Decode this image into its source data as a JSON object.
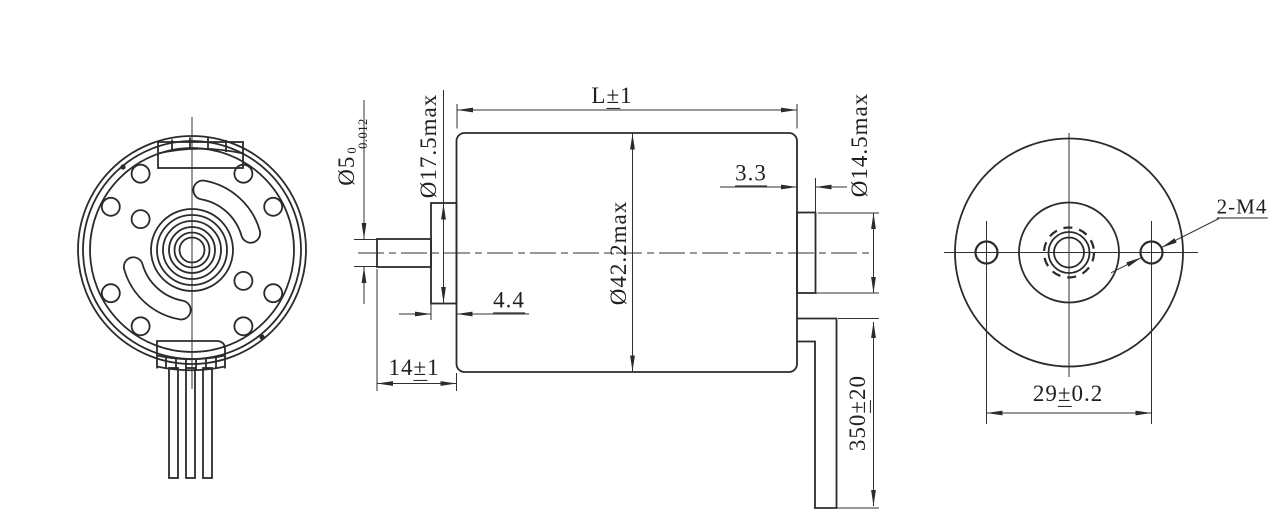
{
  "palette": {
    "background": "#ffffff",
    "line_color": "#2b2b2b"
  },
  "dimensions": {
    "body_length": {
      "prefix": "L",
      "pm": "±",
      "suffix": "1"
    },
    "shaft_diameter": {
      "value": "Ø5",
      "tol_upper": "0",
      "tol_lower": "-0.012"
    },
    "front_boss_diameter": {
      "value": "Ø17.5max"
    },
    "body_diameter": {
      "value": "Ø42.2max"
    },
    "rear_boss_diameter": {
      "value": "Ø14.5max"
    },
    "rear_boss_length": {
      "value": "3.3"
    },
    "front_boss_length": {
      "value": "4.4"
    },
    "shaft_length": {
      "prefix": "14",
      "pm": "±",
      "suffix": "1"
    },
    "lead_wire_length": {
      "prefix": "350",
      "pm": "±",
      "suffix": "20"
    },
    "mounting_hole_spacing": {
      "prefix": "29",
      "pm": "±",
      "suffix": "0.2"
    },
    "mounting_holes_label": {
      "value": "2-M4"
    }
  }
}
